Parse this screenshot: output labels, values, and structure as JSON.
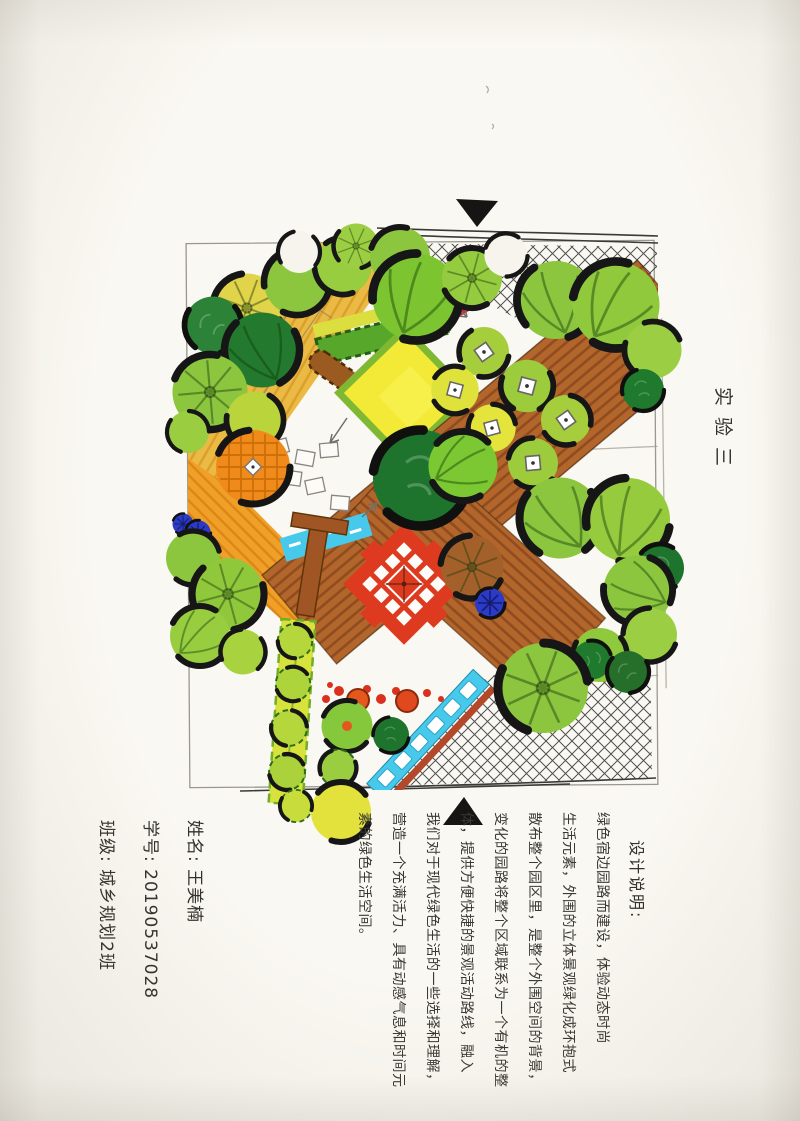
{
  "page": {
    "title_vertical": "实验三"
  },
  "student_info": {
    "name_label": "姓名:",
    "name_value": "王美楠",
    "id_label": "学号:",
    "id_value": "20190537028",
    "class_label": "班级:",
    "class_value": "城乡规划2班"
  },
  "design_note": {
    "heading": "设计说明:",
    "lines": [
      "绿色宿边园路而建设，体验动态时尚",
      "生活元素，外围的立体景观绿化成环抱式",
      "散布整个园区里，是整个外围空间的背景，",
      "变化的园路将整个区域联系为一个有机的整",
      "体，提供方便快捷的景观活动路线，融入",
      "我们对于现代绿色生活的一些选择和理解，",
      "营造一个充满活力、具有动感气息和时间元",
      "素的绿色生活空间。"
    ]
  },
  "plan": {
    "kind": "hand-drawn landscape site plan (marker rendering)",
    "colors": {
      "paper": "#faf8f2",
      "tree_light_green": "#8cc63f",
      "tree_dark_green": "#1e742c",
      "tree_yellow_green": "#c3dc3c",
      "tree_orange": "#f08a1a",
      "path_gold": "#eaba45",
      "path_orange": "#efa028",
      "deck_brown": "#b2662c",
      "plaza_red": "#de3a20",
      "water_cyan": "#47c9ec",
      "accent_blue": "#2b3bc8",
      "outline_black": "#161616",
      "pencil_gray": "#8a8a85"
    },
    "features": [
      "entrance-arrow-top",
      "entrance-arrow-bottom",
      "crosshatch-paving-top",
      "crosshatch-paving-bottom",
      "golden-diagonal-path",
      "wood-deck-bands",
      "central-red-tile-plaza",
      "water-channel-with-bridge",
      "tree-canopies",
      "topiary-ball-cluster",
      "hedge-row",
      "flower-dot-row"
    ]
  }
}
